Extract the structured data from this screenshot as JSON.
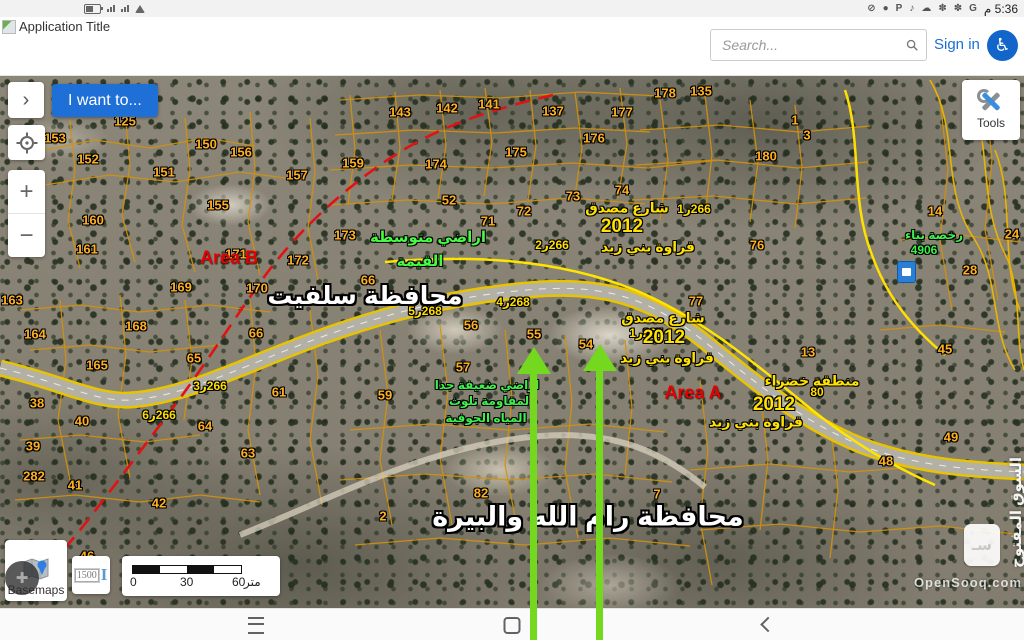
{
  "status_bar": {
    "time": "م 5:36",
    "left_icons": [
      "battery-icon",
      "signal-icon",
      "signal-icon",
      "wifi-icon"
    ],
    "right_icons": [
      {
        "name": "google-icon",
        "g": "G"
      },
      {
        "name": "pinwheel-icon",
        "g": "✽"
      },
      {
        "name": "pinwheel-icon",
        "g": "✽"
      },
      {
        "name": "cloud-upload-icon",
        "g": "☁"
      },
      {
        "name": "tiktok-icon",
        "g": "♪"
      },
      {
        "name": "parking-icon",
        "g": "P"
      },
      {
        "name": "chat-icon",
        "g": "●"
      },
      {
        "name": "notifications-muted-icon",
        "g": "⊘"
      }
    ]
  },
  "header": {
    "app_title": "Application Title",
    "search_placeholder": "Search...",
    "sign_in": "Sign in"
  },
  "controls": {
    "i_want_to": "I want to...",
    "tools": "Tools",
    "basemaps": "Basemaps",
    "scale_value": "1500"
  },
  "icons": {
    "panel_chevron": "›",
    "zoom_in": "+",
    "zoom_out": "−",
    "accessibility": "♿",
    "assist": "✚",
    "ibeam": "I"
  },
  "scale_bar": {
    "t0": "0",
    "t1": "30",
    "t2": "60",
    "unit": "متر"
  },
  "watermark": {
    "arabic": "السوق المفتوح",
    "latin": "OpenSooq.com",
    "logo_glyph": "سـ"
  },
  "map": {
    "colors": {
      "parcel_line": "#d4920c",
      "road_yellow": "#e8c400",
      "road_gray": "#b3b0a6",
      "red_line": "#e31212",
      "arrow_green": "#74d91e"
    },
    "labels": [
      {
        "t": "143",
        "x": 400,
        "y": 112,
        "c": "p"
      },
      {
        "t": "142",
        "x": 447,
        "y": 108,
        "c": "p"
      },
      {
        "t": "141",
        "x": 489,
        "y": 104,
        "c": "p"
      },
      {
        "t": "137",
        "x": 553,
        "y": 111,
        "c": "p"
      },
      {
        "t": "177",
        "x": 622,
        "y": 112,
        "c": "p"
      },
      {
        "t": "178",
        "x": 665,
        "y": 93,
        "c": "p"
      },
      {
        "t": "135",
        "x": 701,
        "y": 91,
        "c": "p"
      },
      {
        "t": "176",
        "x": 594,
        "y": 138,
        "c": "p"
      },
      {
        "t": "159",
        "x": 353,
        "y": 163,
        "c": "p"
      },
      {
        "t": "174",
        "x": 436,
        "y": 164,
        "c": "p"
      },
      {
        "t": "175",
        "x": 516,
        "y": 152,
        "c": "p"
      },
      {
        "t": "52",
        "x": 449,
        "y": 200,
        "c": "p"
      },
      {
        "t": "71",
        "x": 488,
        "y": 221,
        "c": "p"
      },
      {
        "t": "72",
        "x": 524,
        "y": 211,
        "c": "p"
      },
      {
        "t": "73",
        "x": 573,
        "y": 196,
        "c": "p"
      },
      {
        "t": "74",
        "x": 622,
        "y": 190,
        "c": "p"
      },
      {
        "t": "76",
        "x": 757,
        "y": 245,
        "c": "p"
      },
      {
        "t": "77",
        "x": 696,
        "y": 301,
        "c": "p"
      },
      {
        "t": "13",
        "x": 808,
        "y": 352,
        "c": "p"
      },
      {
        "t": "14",
        "x": 935,
        "y": 211,
        "c": "p"
      },
      {
        "t": "24",
        "x": 1012,
        "y": 234,
        "c": "p"
      },
      {
        "t": "28",
        "x": 970,
        "y": 270,
        "c": "p"
      },
      {
        "t": "1",
        "x": 795,
        "y": 120,
        "c": "p"
      },
      {
        "t": "3",
        "x": 807,
        "y": 135,
        "c": "p"
      },
      {
        "t": "180",
        "x": 766,
        "y": 156,
        "c": "p"
      },
      {
        "t": "153",
        "x": 55,
        "y": 138,
        "c": "p"
      },
      {
        "t": "150",
        "x": 206,
        "y": 144,
        "c": "p"
      },
      {
        "t": "156",
        "x": 241,
        "y": 152,
        "c": "p"
      },
      {
        "t": "155",
        "x": 218,
        "y": 205,
        "c": "p"
      },
      {
        "t": "152",
        "x": 88,
        "y": 159,
        "c": "p"
      },
      {
        "t": "151",
        "x": 164,
        "y": 172,
        "c": "p"
      },
      {
        "t": "157",
        "x": 297,
        "y": 175,
        "c": "p"
      },
      {
        "t": "125",
        "x": 125,
        "y": 121,
        "c": "p"
      },
      {
        "t": "160",
        "x": 93,
        "y": 220,
        "c": "p"
      },
      {
        "t": "161",
        "x": 87,
        "y": 249,
        "c": "p"
      },
      {
        "t": "166",
        "x": 22,
        "y": 222,
        "c": "p"
      },
      {
        "t": "169",
        "x": 181,
        "y": 287,
        "c": "p"
      },
      {
        "t": "170",
        "x": 257,
        "y": 288,
        "c": "p"
      },
      {
        "t": "171",
        "x": 236,
        "y": 254,
        "c": "p"
      },
      {
        "t": "172",
        "x": 298,
        "y": 260,
        "c": "p"
      },
      {
        "t": "173",
        "x": 345,
        "y": 235,
        "c": "p"
      },
      {
        "t": "163",
        "x": 12,
        "y": 300,
        "c": "p"
      },
      {
        "t": "164",
        "x": 35,
        "y": 334,
        "c": "p"
      },
      {
        "t": "168",
        "x": 136,
        "y": 326,
        "c": "p"
      },
      {
        "t": "165",
        "x": 97,
        "y": 365,
        "c": "p"
      },
      {
        "t": "66",
        "x": 256,
        "y": 333,
        "c": "p"
      },
      {
        "t": "66",
        "x": 368,
        "y": 280,
        "c": "p"
      },
      {
        "t": "65",
        "x": 194,
        "y": 358,
        "c": "p"
      },
      {
        "t": "38",
        "x": 37,
        "y": 403,
        "c": "p"
      },
      {
        "t": "40",
        "x": 82,
        "y": 421,
        "c": "p"
      },
      {
        "t": "39",
        "x": 33,
        "y": 446,
        "c": "p"
      },
      {
        "t": "282",
        "x": 34,
        "y": 476,
        "c": "p"
      },
      {
        "t": "41",
        "x": 75,
        "y": 485,
        "c": "p"
      },
      {
        "t": "42",
        "x": 159,
        "y": 503,
        "c": "p"
      },
      {
        "t": "61",
        "x": 279,
        "y": 392,
        "c": "p"
      },
      {
        "t": "64",
        "x": 205,
        "y": 426,
        "c": "p"
      },
      {
        "t": "63",
        "x": 248,
        "y": 453,
        "c": "p"
      },
      {
        "t": "56",
        "x": 471,
        "y": 325,
        "c": "p"
      },
      {
        "t": "55",
        "x": 534,
        "y": 334,
        "c": "p"
      },
      {
        "t": "54",
        "x": 586,
        "y": 344,
        "c": "p"
      },
      {
        "t": "57",
        "x": 463,
        "y": 367,
        "c": "p"
      },
      {
        "t": "59",
        "x": 385,
        "y": 395,
        "c": "p"
      },
      {
        "t": "82",
        "x": 481,
        "y": 493,
        "c": "p"
      },
      {
        "t": "2",
        "x": 383,
        "y": 516,
        "c": "p"
      },
      {
        "t": "7",
        "x": 657,
        "y": 494,
        "c": "p"
      },
      {
        "t": "46",
        "x": 87,
        "y": 556,
        "c": "p"
      },
      {
        "t": "48",
        "x": 886,
        "y": 461,
        "c": "p"
      },
      {
        "t": "49",
        "x": 951,
        "y": 437,
        "c": "p"
      },
      {
        "t": "45",
        "x": 945,
        "y": 349,
        "c": "p"
      },
      {
        "t": "1ر266",
        "x": 694,
        "y": 209,
        "c": "rn"
      },
      {
        "t": "2ر266",
        "x": 552,
        "y": 245,
        "c": "rn"
      },
      {
        "t": "3ر266",
        "x": 210,
        "y": 386,
        "c": "rn"
      },
      {
        "t": "6ر266",
        "x": 159,
        "y": 415,
        "c": "rn"
      },
      {
        "t": "4ر268",
        "x": 513,
        "y": 302,
        "c": "rn"
      },
      {
        "t": "5ر268",
        "x": 425,
        "y": 311,
        "c": "rn"
      },
      {
        "t": "1ر267",
        "x": 646,
        "y": 333,
        "c": "rn"
      },
      {
        "t": "80",
        "x": 817,
        "y": 392,
        "c": "rn"
      },
      {
        "t": "شارع مصدق",
        "x": 627,
        "y": 208,
        "c": "st"
      },
      {
        "t": "قراوة بني زيد",
        "x": 648,
        "y": 247,
        "c": "st"
      },
      {
        "t": "شارع مصدق",
        "x": 663,
        "y": 318,
        "c": "st"
      },
      {
        "t": "قراوة بني زيد",
        "x": 667,
        "y": 358,
        "c": "st"
      },
      {
        "t": "منطقة خضراء",
        "x": 812,
        "y": 381,
        "c": "st"
      },
      {
        "t": "قراوة بني زيد",
        "x": 756,
        "y": 422,
        "c": "st"
      },
      {
        "t": "2012",
        "x": 622,
        "y": 227,
        "c": "yr"
      },
      {
        "t": "2012",
        "x": 664,
        "y": 338,
        "c": "yr"
      },
      {
        "t": "2012",
        "x": 774,
        "y": 405,
        "c": "yr"
      },
      {
        "t": "اراضي متوسطة",
        "x": 428,
        "y": 237,
        "c": "g1"
      },
      {
        "t": "القيمة",
        "x": 420,
        "y": 261,
        "c": "g1"
      },
      {
        "t": "رخصة بناء",
        "x": 934,
        "y": 235,
        "c": "g2"
      },
      {
        "t": "4906",
        "x": 924,
        "y": 250,
        "c": "g2"
      },
      {
        "t": "اراضي ضعيفة جدا",
        "x": 487,
        "y": 385,
        "c": "g2"
      },
      {
        "t": "لمقاومة تلوث",
        "x": 489,
        "y": 401,
        "c": "g2"
      },
      {
        "t": "المياه الجوفية",
        "x": 486,
        "y": 418,
        "c": "g2"
      },
      {
        "t": "محافظة سلفيت",
        "x": 365,
        "y": 296,
        "c": "gv1"
      },
      {
        "t": "محافظة رام الله والبيرة",
        "x": 588,
        "y": 517,
        "c": "gv2"
      },
      {
        "t": "Area B",
        "x": 229,
        "y": 258,
        "c": "ar"
      },
      {
        "t": "Area A",
        "x": 693,
        "y": 393,
        "c": "ar"
      }
    ]
  }
}
